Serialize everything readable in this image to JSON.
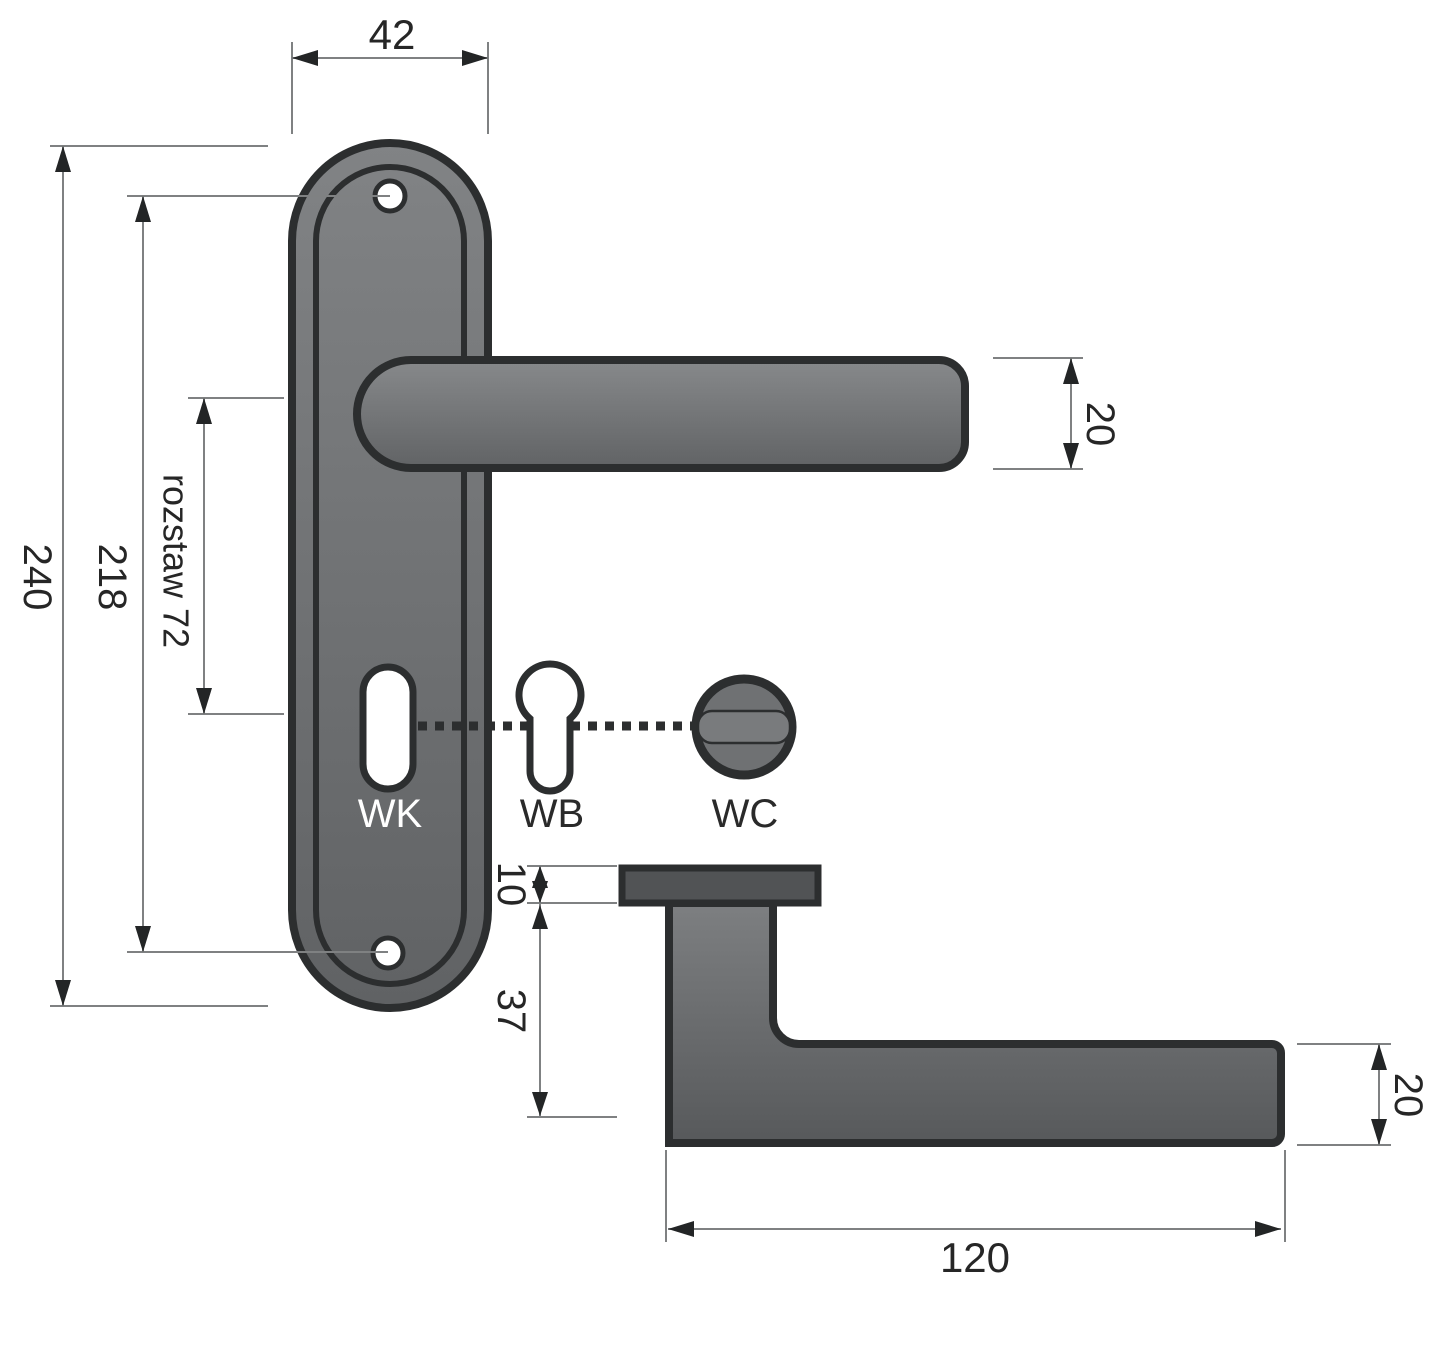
{
  "drawing": {
    "kind": "door-handle dimensional drawing",
    "front": {
      "dim_plate_width": "42",
      "dim_overall_height": "240",
      "dim_hole_spacing": "218",
      "dim_key_spacing": "rozstaw 72",
      "dim_lever_thickness": "20",
      "label_wk": "WK",
      "label_wb": "WB",
      "label_wc": "WC"
    },
    "side": {
      "dim_rosette_thickness": "10",
      "dim_neck_height": "37",
      "dim_lever_thickness": "20",
      "dim_lever_length": "120"
    },
    "colors": {
      "outline": "#2c2e2f",
      "dimension_line": "#7f8182",
      "arrow": "#232526",
      "text": "#262626",
      "metal_light": "#85878a",
      "metal_dark": "#58595b",
      "thumbturn_fill": "#6f7173",
      "rosette_fill": "#515355",
      "hole_fill": "#ffffff"
    }
  }
}
